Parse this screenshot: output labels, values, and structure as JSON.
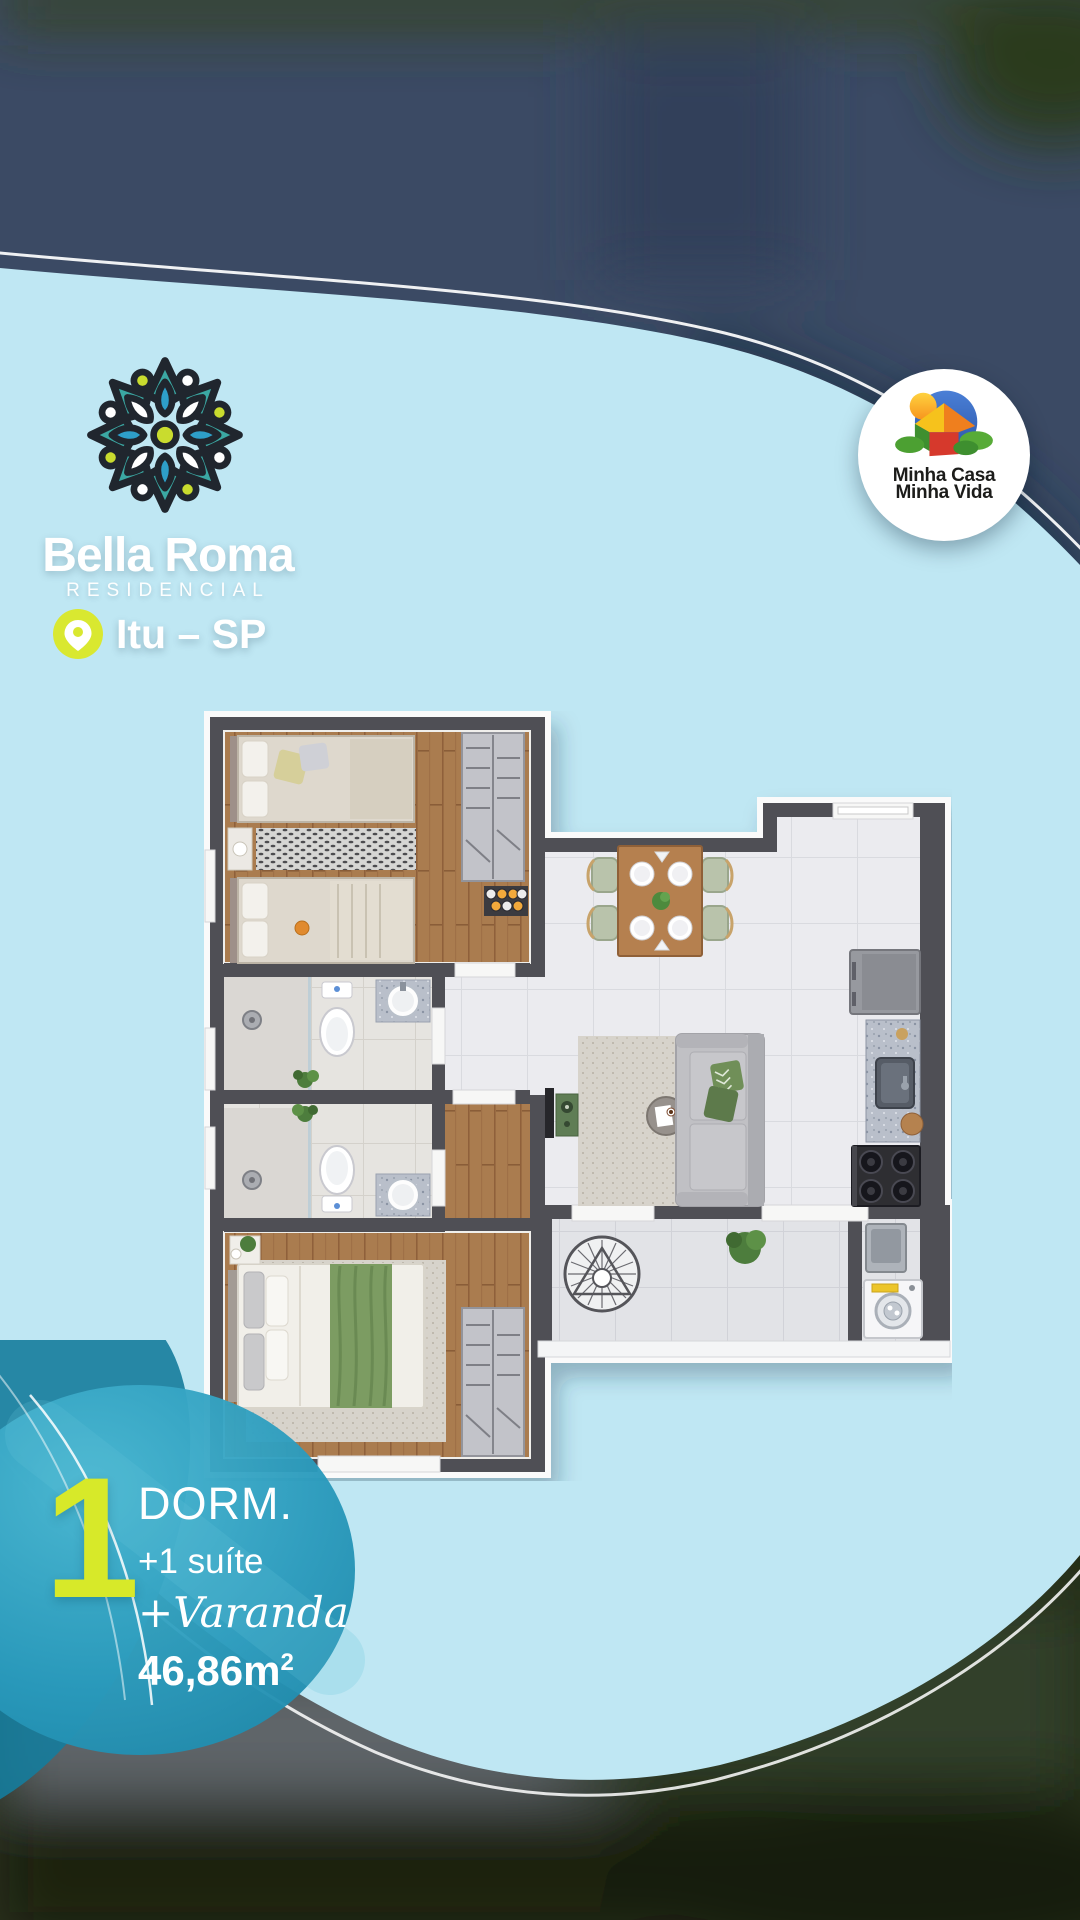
{
  "brand": {
    "name": "Bella Roma",
    "subtitle": "RESIDENCIAL",
    "location": "Itu – SP"
  },
  "program_badge": {
    "line1": "Minha Casa",
    "line2": "Minha Vida"
  },
  "unit_info": {
    "big_number": "1",
    "dorm_label": "DORM.",
    "suite_label": "+1 suíte",
    "varanda_label": "+Varanda",
    "area_value": "46,86m",
    "area_sup": "2"
  },
  "colors": {
    "light_blue_blob": "#bfe7f3",
    "navy_background": "#3b4a64",
    "teal_badge": "#2496b8",
    "lime_accent": "#d7e929",
    "wall_gray": "#4f4f54",
    "wood_floor": "#aa7c50"
  },
  "icons": {
    "logo": "mandala-flower",
    "location": "map-pin",
    "program": "mcmv-house-sun"
  }
}
